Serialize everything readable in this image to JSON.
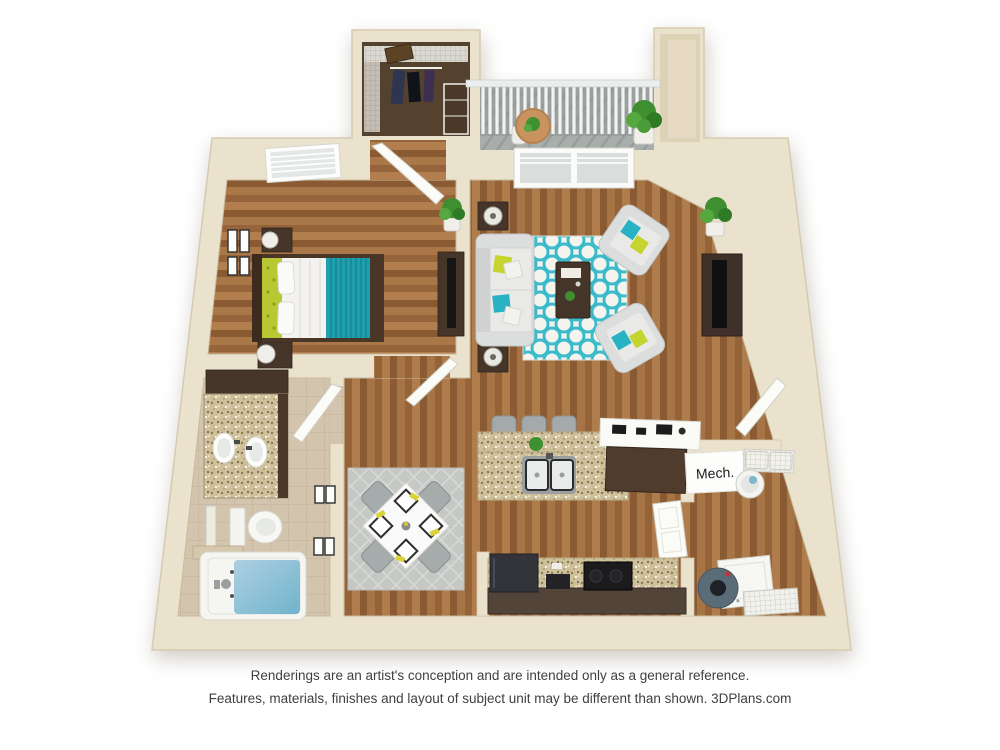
{
  "page": {
    "background": "#ffffff"
  },
  "footer": {
    "disclaimer_line1": "Renderings are an artist's conception and are intended only as a general reference.",
    "disclaimer_line2": "Features, materials, finishes and layout of subject unit may be different than shown. 3DPlans.com",
    "brand": "3DPlans.com"
  },
  "floorplan": {
    "kind": "3D top-down apartment floor plan rendering, one bedroom / one bathroom",
    "labels": {
      "mech": "Mech."
    },
    "rooms": [
      "closet",
      "balcony",
      "bedroom",
      "living-room",
      "kitchen",
      "dining-area",
      "hallway",
      "bathroom",
      "mechanical-closet",
      "laundry-storage",
      "entry"
    ],
    "palette": {
      "wall_cream": "#eae2cd",
      "wall_shade": "#d5c9ae",
      "wood_floor": "#9c6a3e",
      "tile_floor": "#d3c4ad",
      "deck_gray": "#a9adac",
      "rug_teal": "#3cbccb",
      "rug_gray": "#c5c8c5",
      "sofa_gray": "#dcdedd",
      "accent_teal": "#1d9fae",
      "accent_chartreuse": "#c5d42f",
      "dark_wood": "#46362a",
      "granite_tan": "#cfc09c",
      "tub_water_blue": "#8fc0d8",
      "appliance_black": "#1b1b1d"
    }
  }
}
